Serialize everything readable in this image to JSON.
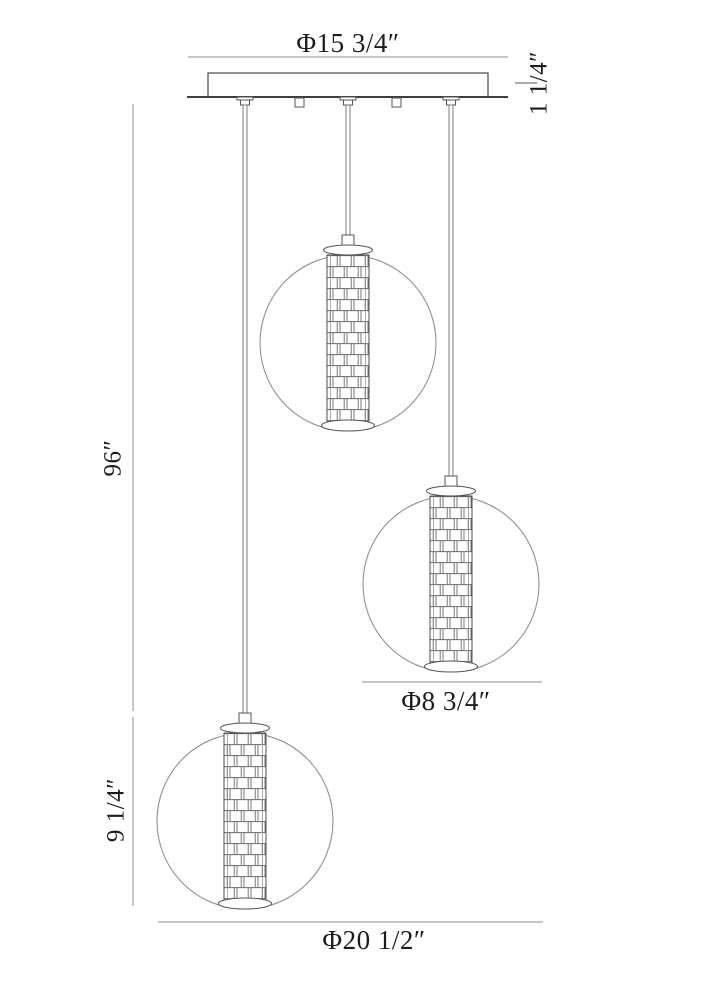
{
  "labels": {
    "canopy_diameter": "Φ15 3/4″",
    "canopy_height": "1 1/4″",
    "drop_length": "96″",
    "pendant_height": "9 1/4″",
    "globe_diameter": "Φ8 3/4″",
    "overall_width": "Φ20 1/2″"
  },
  "colors": {
    "background": "#ffffff",
    "drawing_line": "#4a4a4a",
    "dimension_line": "#8f8f8f",
    "text": "#1c1c1c"
  }
}
